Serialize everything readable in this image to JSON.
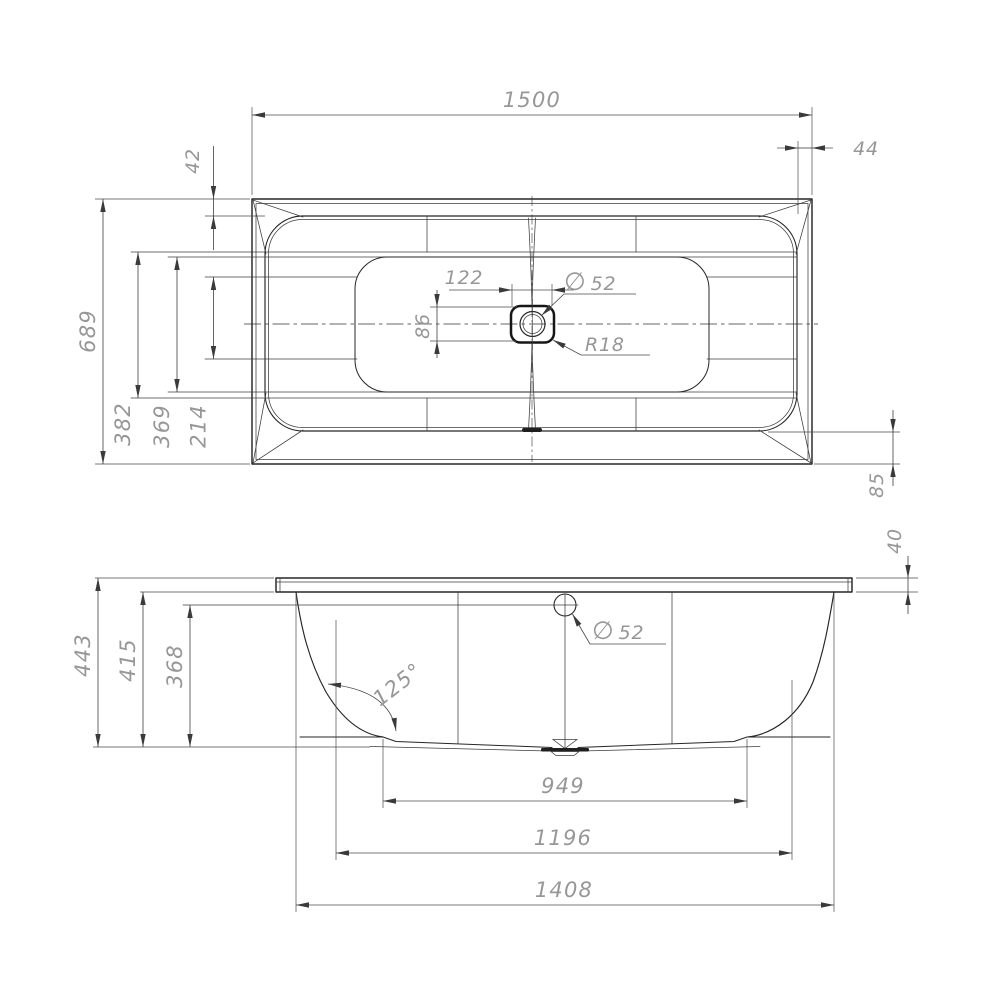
{
  "dims": {
    "top_view": {
      "overall_length": "1500",
      "rim_right": "44",
      "rim_top": "42",
      "overall_width": "689",
      "basin_width_outer": "382",
      "basin_width_mid": "369",
      "basin_width_inner": "214",
      "drain_offset_x": "122",
      "drain_offset_y": "86",
      "drain_dia_symbol": "∅",
      "drain_dia_value": "52",
      "drain_corner_radius": "R18",
      "rim_bottom": "85"
    },
    "side_view": {
      "overall_height": "443",
      "inner_height": "415",
      "overflow_height": "368",
      "rim_thickness": "40",
      "wall_angle": "125°",
      "overflow_dia_symbol": "∅",
      "overflow_dia_value": "52",
      "bottom_length": "949",
      "mid_length": "1196",
      "top_length": "1408"
    }
  },
  "colors": {
    "line": "#262626",
    "dim_line": "#4b4b4b",
    "dim_text": "#979797",
    "background": "#ffffff"
  }
}
